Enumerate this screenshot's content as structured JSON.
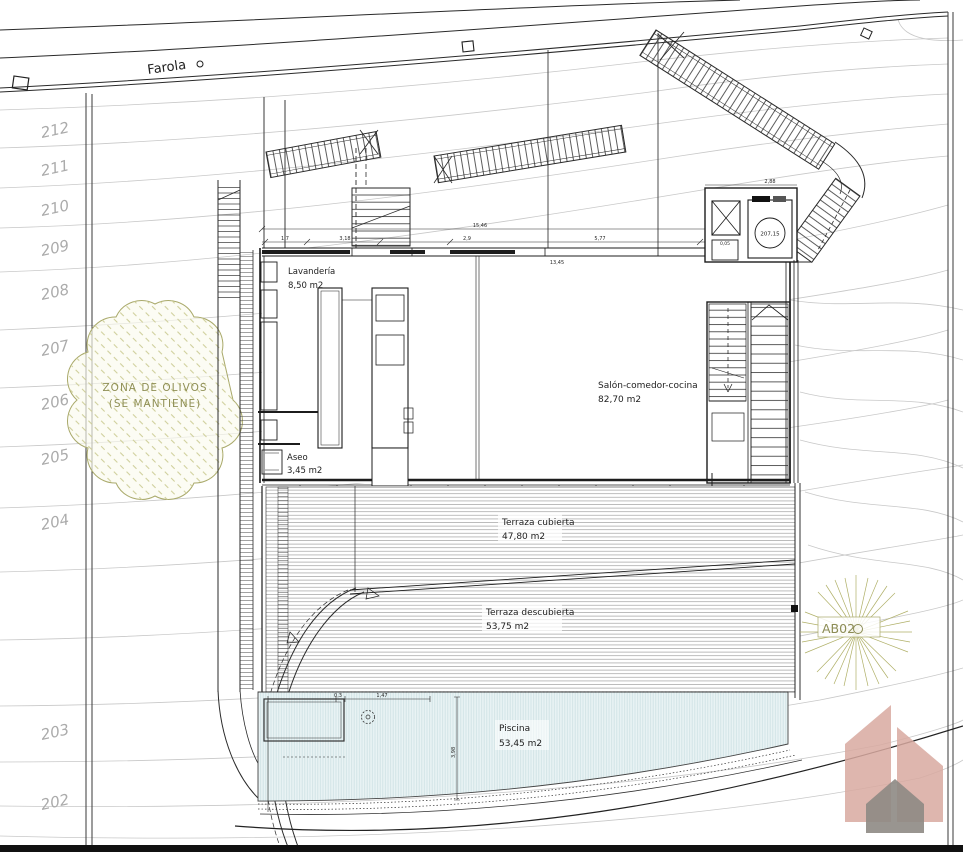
{
  "road": {
    "label": "Farola"
  },
  "contours": [
    "212",
    "211",
    "210",
    "209",
    "208",
    "207",
    "206",
    "205",
    "204",
    "203",
    "202"
  ],
  "olive": {
    "l1": "ZONA DE OLIVOS",
    "l2": "(SE MANTIENE)"
  },
  "tree": {
    "tag": "AB02"
  },
  "entry": {
    "level": "207,15",
    "width": "2,88",
    "offset": "0,05"
  },
  "rooms": {
    "lavanderia": {
      "name": "Lavandería",
      "area": "8,50 m2"
    },
    "aseo": {
      "name": "Aseo",
      "area": "3,45 m2"
    },
    "salon": {
      "name": "Salón-comedor-cocina",
      "area": "82,70 m2"
    },
    "cubierta": {
      "name": "Terraza cubierta",
      "area": "47,80 m2"
    },
    "descubierta": {
      "name": "Terraza descubierta",
      "area": "53,75 m2"
    },
    "piscina": {
      "name": "Piscina",
      "area": "53,45 m2"
    }
  },
  "dims": {
    "overall": "15,46",
    "s1": "1,7",
    "s2": "3,18",
    "s3": "2,9",
    "s4": "5,77",
    "inner": "13,45",
    "p1": "0,3",
    "p2": "1,47",
    "pd": "3,98"
  },
  "stairs": {
    "interior_steps_left": "23-35",
    "interior_steps_right": "3-21"
  },
  "colors": {
    "line": "#1c1c1c",
    "contour": "#c8c8c8",
    "pool_fill": "#e9f3f4",
    "olive": "#9a9a5e",
    "logo_pink": "#d8a9a0",
    "logo_gray": "#8e8984"
  }
}
